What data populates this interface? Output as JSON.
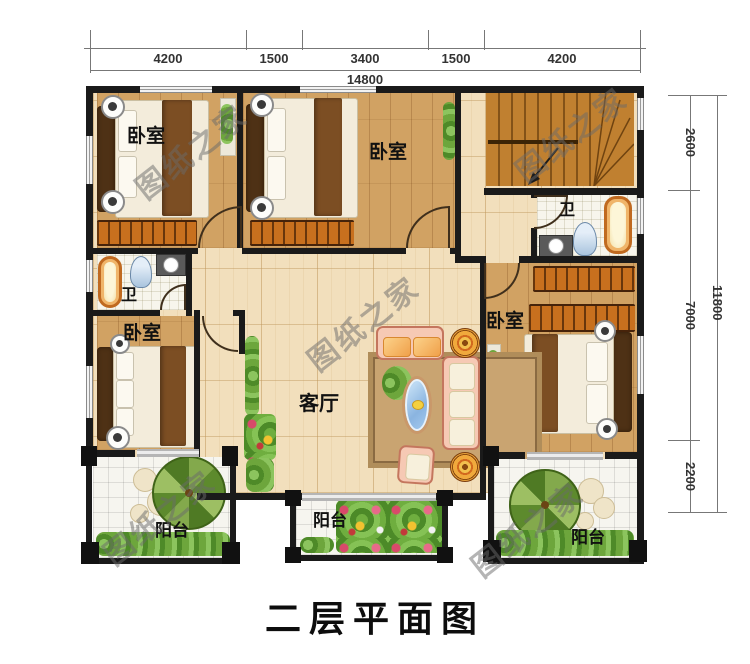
{
  "title": "二层平面图",
  "watermark": {
    "text": "图纸之家"
  },
  "dimensions": {
    "top": {
      "segments": [
        "4200",
        "1500",
        "3400",
        "1500",
        "4200"
      ],
      "total": "14800"
    },
    "right": {
      "segments": [
        "2600",
        "7000",
        "2200"
      ],
      "total": "11800"
    }
  },
  "rooms": {
    "bedroom_nw": "卧室",
    "bedroom_n": "卧室",
    "bedroom_sw": "卧室",
    "bedroom_e": "卧室",
    "living": "客厅",
    "bath_w": "卫",
    "bath_e": "卫",
    "balcony_sw": "阳台",
    "balcony_s": "阳台",
    "balcony_se": "阳台"
  },
  "palette": {
    "wall": "#1a1a1a",
    "oak_floor": "#d1a263",
    "light_floor": "#f2dfbc",
    "tile": "#f6f5ef",
    "stairs": "#c08030",
    "wardrobe": "#c8701e",
    "sofa": "#f6c9b4",
    "glass": "#8ab4e0",
    "greenery": "#5a9338",
    "rug": "#c9a471"
  }
}
